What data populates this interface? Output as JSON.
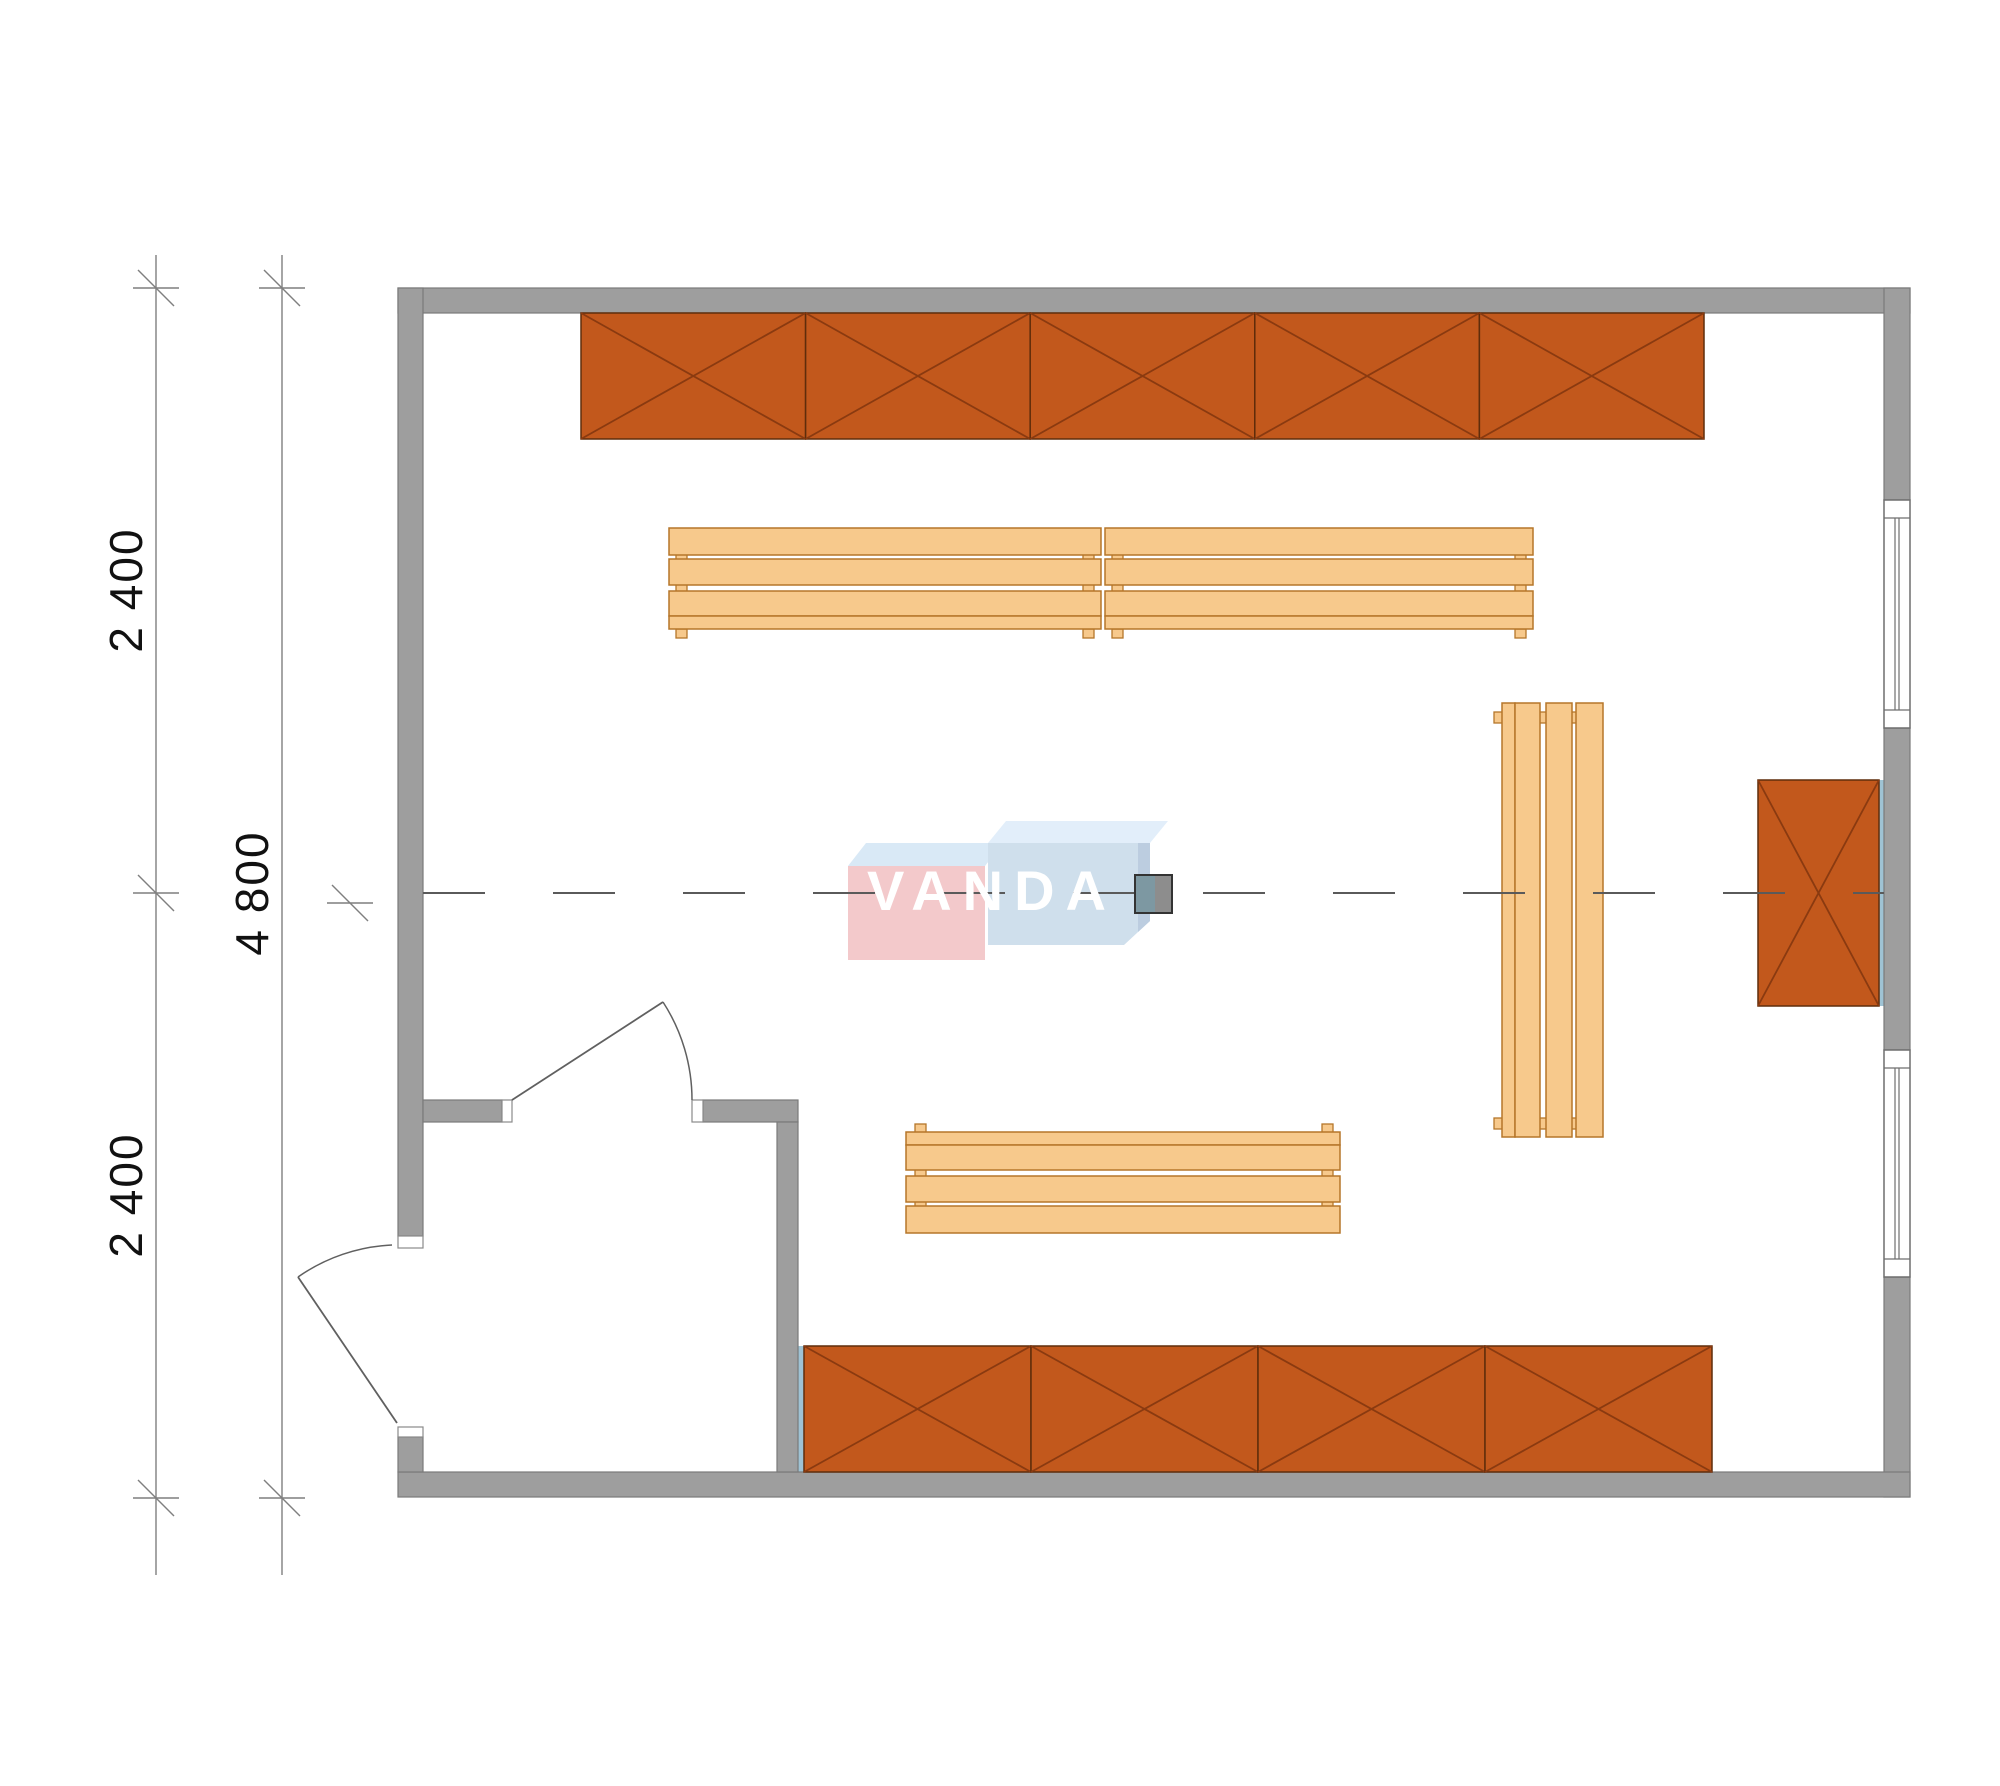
{
  "title": "Room floor plan 4800 x 2400+2400 with cabinets and benches",
  "watermark": {
    "text": "VANDA"
  },
  "colors": {
    "background": "#ffffff",
    "wall_fill": "#9e9e9e",
    "wall_edge": "#7a7a7a",
    "jamb_fill": "#ffffff",
    "jamb_edge": "#8a8a8a",
    "window_edge": "#6e6e6e",
    "cabinet_fill": "#c2581c",
    "cabinet_edge": "#5f2d0b",
    "cabinet_x": "#8a3a10",
    "bench_fill": "#f7c98c",
    "bench_edge": "#b5762a",
    "blue_strip": "#9fc3d4",
    "door_line": "#606060",
    "dim_line": "#7f7f7f",
    "dim_text": "#111111",
    "centerline": "#5a5a5a",
    "logo_pink": "#f3c9cb",
    "logo_blue": "#cfdfec",
    "logo_bevel_light": "#d9e9f6",
    "logo_bevel_lighter": "#e2eefa",
    "logo_blue_shade": "#bccde0",
    "logo_text": "#ffffff",
    "marker_teal": "#7d98a2",
    "marker_gray": "#8d8d8d",
    "marker_edge": "#333333"
  },
  "dimensions": {
    "line_top_y": 255,
    "line_bottom_y": 1575,
    "lines": [
      {
        "name": "dim-line-inner",
        "x": 156,
        "ticks": [
          288,
          893,
          1498
        ]
      },
      {
        "name": "dim-line-outer",
        "x": 282,
        "ticks": [
          288,
          1498
        ]
      }
    ],
    "extra_ticks": [
      {
        "x": 350,
        "y": 903
      }
    ],
    "labels": [
      {
        "text": "2 400",
        "x": 126,
        "y": 590
      },
      {
        "text": "4 800",
        "x": 252,
        "y": 893
      },
      {
        "text": "2 400",
        "x": 126,
        "y": 1195
      }
    ]
  },
  "walls": [
    {
      "name": "wall-top",
      "x": 398,
      "y": 288,
      "w": 1512,
      "h": 25
    },
    {
      "name": "wall-right-upper",
      "x": 1884,
      "y": 288,
      "w": 26,
      "h": 212
    },
    {
      "name": "wall-right-mid",
      "x": 1884,
      "y": 728,
      "w": 26,
      "h": 322
    },
    {
      "name": "wall-right-lower",
      "x": 1884,
      "y": 1277,
      "w": 26,
      "h": 220
    },
    {
      "name": "wall-bottom",
      "x": 398,
      "y": 1472,
      "w": 1512,
      "h": 25
    },
    {
      "name": "wall-left",
      "x": 398,
      "y": 288,
      "w": 25,
      "h": 948
    },
    {
      "name": "wall-left-stub",
      "x": 398,
      "y": 1437,
      "w": 25,
      "h": 35
    },
    {
      "name": "wall-vestibule-left",
      "x": 423,
      "y": 1100,
      "w": 79,
      "h": 22
    },
    {
      "name": "wall-vestibule-right",
      "x": 703,
      "y": 1100,
      "w": 95,
      "h": 22
    },
    {
      "name": "wall-vestibule-side",
      "x": 777,
      "y": 1122,
      "w": 21,
      "h": 350
    }
  ],
  "jambs": [
    {
      "name": "jamb-ext-door-top",
      "x": 398,
      "y": 1236,
      "w": 25,
      "h": 12
    },
    {
      "name": "jamb-ext-door-bottom",
      "x": 398,
      "y": 1427,
      "w": 25,
      "h": 10
    },
    {
      "name": "jamb-int-door-left",
      "x": 502,
      "y": 1100,
      "w": 10,
      "h": 22
    },
    {
      "name": "jamb-int-door-right",
      "x": 692,
      "y": 1100,
      "w": 11,
      "h": 22
    }
  ],
  "windows": [
    {
      "name": "window-upper",
      "x": 1884,
      "y": 500,
      "w": 26,
      "h": 228,
      "frame": 18
    },
    {
      "name": "window-lower",
      "x": 1884,
      "y": 1050,
      "w": 26,
      "h": 227,
      "frame": 18
    }
  ],
  "blue_strips": [
    {
      "name": "strip-top-cabinets",
      "x": 575,
      "y": 306,
      "w": 1135,
      "h": 7
    },
    {
      "name": "strip-bottom-cabinets",
      "x": 797,
      "y": 1346,
      "w": 7,
      "h": 126
    },
    {
      "name": "strip-right-cabinet",
      "x": 1879,
      "y": 780,
      "w": 6,
      "h": 226
    }
  ],
  "cabinet_rows": [
    {
      "name": "cabinet-row-top",
      "x": 581,
      "y": 313,
      "w": 1123,
      "h": 126,
      "units": 5,
      "dir": "h"
    },
    {
      "name": "cabinet-row-bottom",
      "x": 804,
      "y": 1346,
      "w": 908,
      "h": 126,
      "units": 4,
      "dir": "h"
    },
    {
      "name": "cabinet-right-wall",
      "x": 1758,
      "y": 780,
      "w": 121,
      "h": 226,
      "units": 1,
      "dir": "v"
    }
  ],
  "benches": [
    {
      "name": "bench-upper-left",
      "dir": "h",
      "x": 669,
      "len": 432,
      "strips": [
        {
          "o": 528,
          "s": 27
        },
        {
          "o": 559,
          "s": 26
        },
        {
          "o": 591,
          "s": 25
        },
        {
          "o": 616,
          "s": 13
        }
      ],
      "feet": [
        [
          676,
          553
        ],
        [
          1083,
          553
        ],
        [
          676,
          584
        ],
        [
          1083,
          584
        ],
        [
          676,
          629
        ],
        [
          1083,
          629
        ]
      ]
    },
    {
      "name": "bench-upper-right",
      "dir": "h",
      "x": 1105,
      "len": 428,
      "strips": [
        {
          "o": 528,
          "s": 27
        },
        {
          "o": 559,
          "s": 26
        },
        {
          "o": 591,
          "s": 25
        },
        {
          "o": 616,
          "s": 13
        }
      ],
      "feet": [
        [
          1112,
          553
        ],
        [
          1515,
          553
        ],
        [
          1112,
          584
        ],
        [
          1515,
          584
        ],
        [
          1112,
          629
        ],
        [
          1515,
          629
        ]
      ]
    },
    {
      "name": "bench-lower",
      "dir": "h",
      "x": 906,
      "len": 434,
      "strips": [
        {
          "o": 1132,
          "s": 13
        },
        {
          "o": 1145,
          "s": 25
        },
        {
          "o": 1176,
          "s": 26
        },
        {
          "o": 1206,
          "s": 27
        }
      ],
      "feet": [
        [
          915,
          1124
        ],
        [
          1322,
          1124
        ],
        [
          915,
          1169
        ],
        [
          1322,
          1169
        ],
        [
          915,
          1200
        ],
        [
          1322,
          1200
        ]
      ]
    },
    {
      "name": "bench-vertical",
      "dir": "v",
      "x": 703,
      "len": 434,
      "strips": [
        {
          "o": 1502,
          "s": 13
        },
        {
          "o": 1515,
          "s": 25
        },
        {
          "o": 1546,
          "s": 26
        },
        {
          "o": 1576,
          "s": 27
        }
      ],
      "feet": [
        [
          1494,
          712
        ],
        [
          1494,
          1118
        ],
        [
          1539,
          712
        ],
        [
          1539,
          1118
        ],
        [
          1571,
          712
        ],
        [
          1571,
          1118
        ]
      ]
    }
  ],
  "doors": [
    {
      "name": "door-exterior",
      "leaf": [
        397,
        1423,
        298,
        1277
      ],
      "arc": "M 298 1277 A 177 177 0 0 1 392 1245"
    },
    {
      "name": "door-interior",
      "leaf": [
        512,
        1100,
        663,
        1002
      ],
      "arc": "M 663 1002 A 180 180 0 0 1 692 1100"
    }
  ],
  "centerline": {
    "y": 893,
    "x1": 423,
    "x2": 1884,
    "dash": "62 68"
  },
  "marker": {
    "x": 1135,
    "y": 875,
    "w": 37,
    "h": 38,
    "split": 20
  },
  "logo": {
    "text_x": 992,
    "text_y": 893,
    "boxes": [
      {
        "name": "logo-pink-bevel",
        "points": "848,866 866,843 1003,843 985,866",
        "fill": "logo_bevel_light"
      },
      {
        "name": "logo-pink-face",
        "points": "848,866 985,866 985,960 848,960",
        "fill": "logo_pink"
      },
      {
        "name": "logo-blue-bevel",
        "points": "988,843 1006,821 1168,821 1150,843",
        "fill": "logo_bevel_lighter"
      },
      {
        "name": "logo-blue-face",
        "points": "988,843 1150,843 1150,921 1124,945 988,945",
        "fill": "logo_blue"
      },
      {
        "name": "logo-blue-shade",
        "points": "1138,843 1150,843 1150,921 1138,932",
        "fill": "logo_blue_shade"
      }
    ]
  }
}
